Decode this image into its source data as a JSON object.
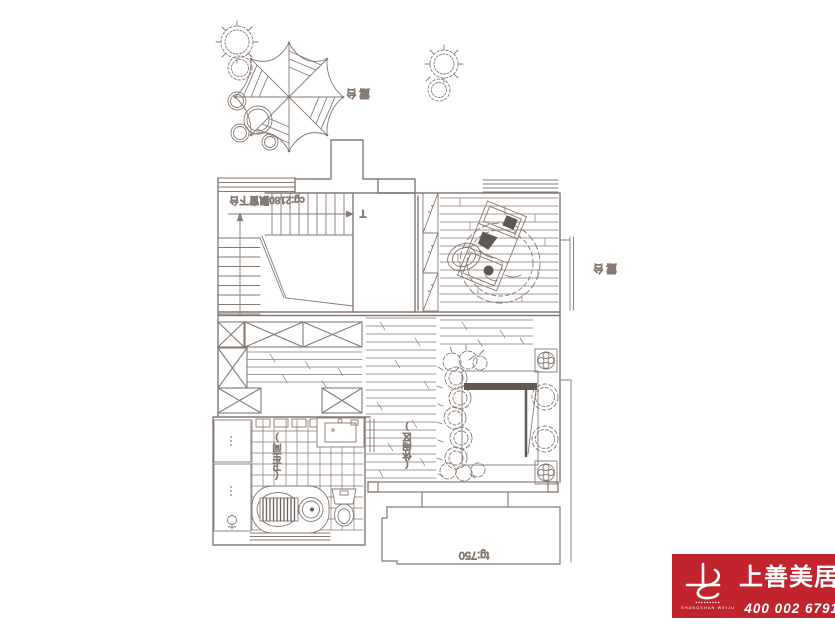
{
  "canvas": {
    "bg": "#ffffff",
    "line_color": "#857a73",
    "dark_color": "#5f5853"
  },
  "floorplan": {
    "labels": {
      "terrace_upper": "露台",
      "terrace_right": "露台",
      "stair_annotation": "cg:2180飘窗下台",
      "stair_mark": "T",
      "bathroom": "(卫生间)",
      "leisure": "(休闲区)",
      "height_note": "tg:750"
    }
  },
  "logo": {
    "brand": "上善美居",
    "latin": "SHANGSHAN WEIJU",
    "dashes": "▪▪▪▪▪▪▪▪▪",
    "phone": "400 002 6791",
    "bg_color": "#c2242e",
    "text_color": "#ffffff"
  }
}
